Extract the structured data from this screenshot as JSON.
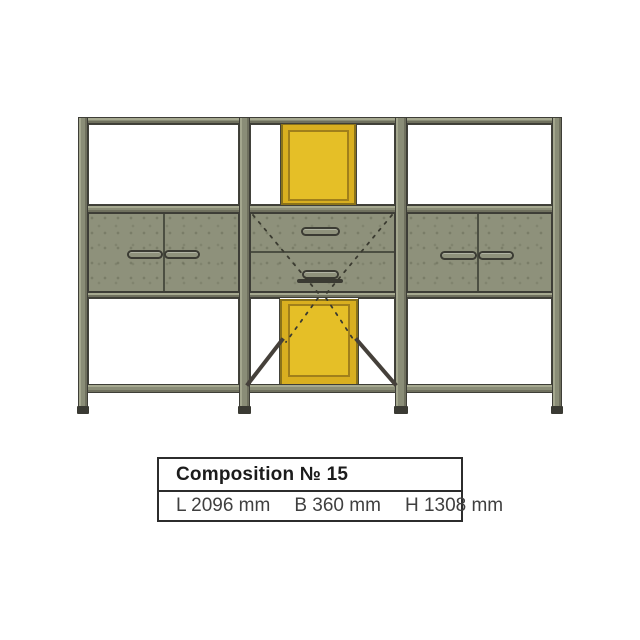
{
  "diagram": {
    "name": "shelving-composition-front-view",
    "colors": {
      "frame_olive": "#8a8d77",
      "panel_olive": "#8e917b",
      "accent_yellow": "#d9af20",
      "accent_yellow_light": "#e5bf27",
      "yellow_border": "#8a721a",
      "outline_dark": "#3d3d36",
      "brace_dark": "#45403a"
    }
  },
  "label_box": {
    "title": "Composition № 15",
    "dimensions": [
      "L 2096 mm",
      "B 360 mm",
      "H 1308 mm"
    ]
  }
}
